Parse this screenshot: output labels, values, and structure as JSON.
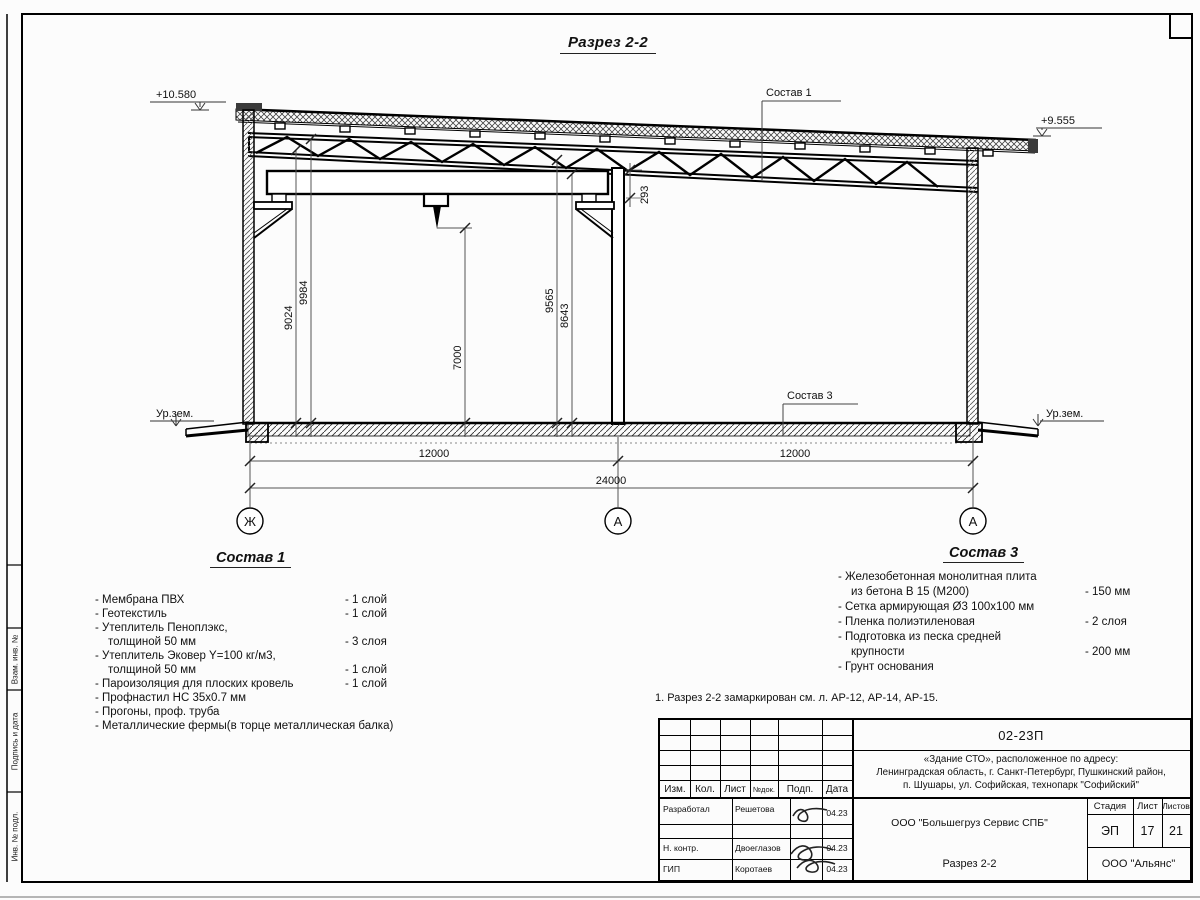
{
  "sheet": {
    "title": "Разрез 2-2"
  },
  "section": {
    "elev_left": "+10.580",
    "elev_right": "+9.555",
    "ground_label_left": "Ур.зем.",
    "ground_label_right": "Ур.зем.",
    "leader1": "Состав 1",
    "leader3": "Состав 3",
    "dim_9024": "9024",
    "dim_9984": "9984",
    "dim_7000": "7000",
    "dim_9565": "9565",
    "dim_8643": "8643",
    "dim_293": "293",
    "dim_span_left": "12000",
    "dim_span_right": "12000",
    "dim_total": "24000",
    "axis_left": "Ж",
    "axis_mid": "А",
    "axis_right": "А"
  },
  "legend1": {
    "heading": "Состав 1",
    "lines": [
      {
        "text": "- Мембрана ПВХ",
        "qty": "- 1 слой"
      },
      {
        "text": "- Геотекстиль",
        "qty": "- 1 слой"
      },
      {
        "text": "- Утеплитель Пеноплэкс,",
        "qty": ""
      },
      {
        "text": "толщиной 50 мм",
        "qty": "- 3 слоя"
      },
      {
        "text": "- Утеплитель Эковер Y=100 кг/м3,",
        "qty": ""
      },
      {
        "text": "толщиной 50 мм",
        "qty": "- 1 слой"
      },
      {
        "text": "- Пароизоляция для плоских кровель",
        "qty": "- 1 слой"
      },
      {
        "text": "- Профнастил НС 35х0.7 мм",
        "qty": ""
      },
      {
        "text": "- Прогоны, проф. труба",
        "qty": ""
      },
      {
        "text": "- Металлические фермы(в торце металлическая балка)",
        "qty": ""
      }
    ]
  },
  "legend3": {
    "heading": "Состав 3",
    "lines": [
      {
        "text": "- Железобетонная  монолитная плита",
        "qty": ""
      },
      {
        "text": "из бетона В 15 (М200)",
        "qty": "- 150 мм"
      },
      {
        "text": "- Сетка армирующая Ø3 100х100 мм",
        "qty": ""
      },
      {
        "text": "- Пленка полиэтиленовая",
        "qty": "-  2 слоя"
      },
      {
        "text": "- Подготовка из песка средней",
        "qty": ""
      },
      {
        "text": "крупности",
        "qty": "- 200 мм"
      },
      {
        "text": "- Грунт основания",
        "qty": ""
      }
    ]
  },
  "note": "1. Разрез 2-2 замаркирован см. л. АР-12, АР-14, АР-15.",
  "stamp": {
    "doc_number": "02-23П",
    "object_line1": "«Здание СТО», расположенное по адресу:",
    "object_line2": "Ленинградская область, г. Санкт-Петербург, Пушкинский район,",
    "object_line3": "п. Шушары, ул. Софийская, технопарк \"Софийский\"",
    "header_cols": [
      "Изм.",
      "Кол.",
      "Лист",
      "№док.",
      "Подп.",
      "Дата"
    ],
    "roles": [
      {
        "role": "Разработал",
        "name": "Решетова",
        "date": "04.23"
      },
      {
        "role": "",
        "name": "",
        "date": ""
      },
      {
        "role": "Н. контр.",
        "name": "Двоеглазов",
        "date": "04.23"
      },
      {
        "role": "ГИП",
        "name": "Коротаев",
        "date": "04.23"
      }
    ],
    "company": "ООО \"Большегруз Сервис СПБ\"",
    "sheet_title": "Разрез 2-2",
    "org": "ООО \"Альянс\"",
    "stage_label": "Стадия",
    "sheet_label": "Лист",
    "sheets_label": "Листов",
    "stage": "ЭП",
    "sheet": "17",
    "sheets": "21"
  },
  "side_strip": {
    "cells": [
      "Взам. инв. №",
      "Подпись и дата",
      "Инв. № подл."
    ]
  }
}
